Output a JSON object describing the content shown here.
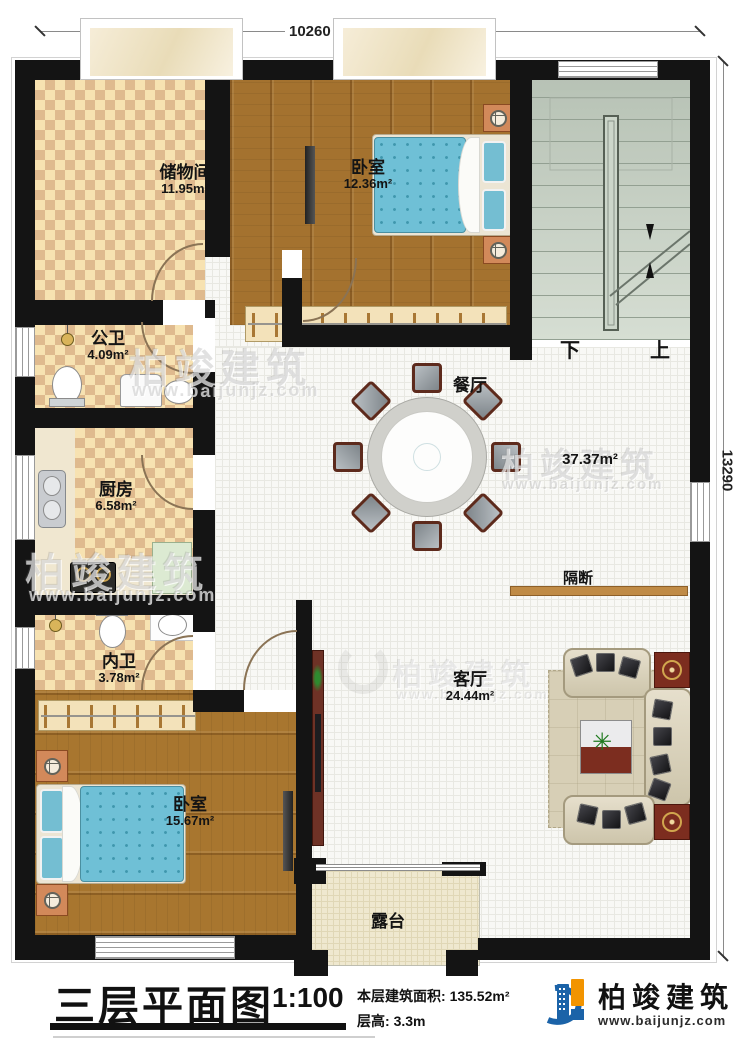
{
  "dimensions": {
    "top_width": "10260",
    "right_height": "13290"
  },
  "rooms": {
    "storage": {
      "name": "储物间",
      "area": "11.95m²"
    },
    "bedroom_top": {
      "name": "卧室",
      "area": "12.36m²"
    },
    "public_bath": {
      "name": "公卫",
      "area": "4.09m²"
    },
    "kitchen": {
      "name": "厨房",
      "area": "6.58m²"
    },
    "inner_bath": {
      "name": "内卫",
      "area": "3.78m²"
    },
    "bedroom_main": {
      "name": "卧室",
      "area": "15.67m²"
    },
    "dining": {
      "name": "餐厅"
    },
    "hall": {
      "area": "37.37m²"
    },
    "partition": {
      "name": "隔断"
    },
    "living": {
      "name": "客厅",
      "area": "24.44m²"
    },
    "terrace": {
      "name": "露台"
    }
  },
  "stairs": {
    "down": "下",
    "up": "上"
  },
  "footer": {
    "title": "三层平面图",
    "scale": "1:100",
    "area_label": "本层建筑面积:",
    "area_value": "135.52m²",
    "floor_height_label": "层高:",
    "floor_height_value": "3.3m"
  },
  "brand": {
    "name": "柏竣建筑",
    "site": "www.baijunjz.com"
  },
  "watermark": {
    "brand": "柏竣建筑",
    "site": "www.baijunjz.com"
  },
  "icons": {
    "plant": "✳"
  }
}
